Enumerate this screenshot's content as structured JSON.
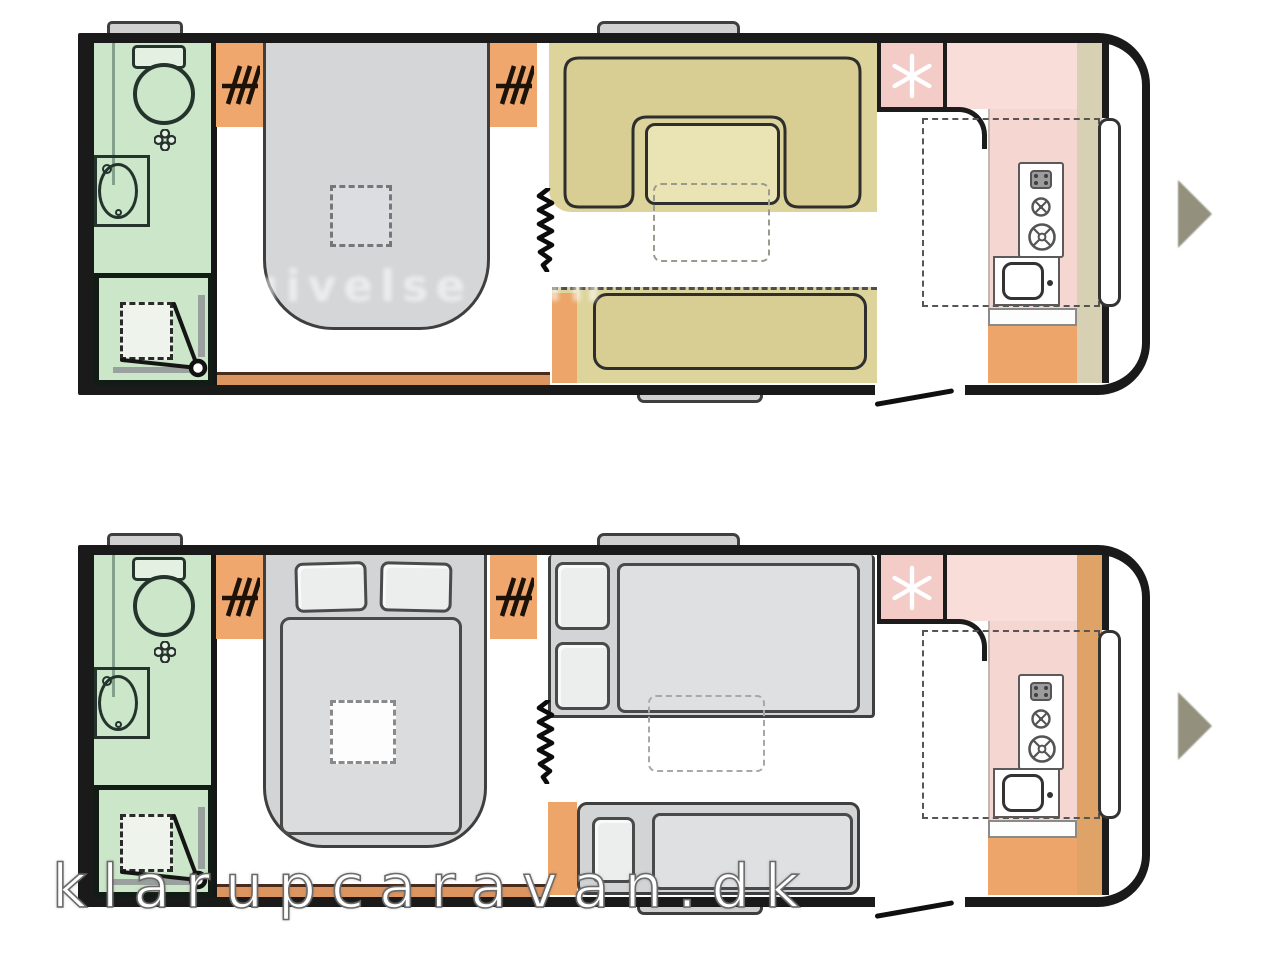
{
  "image": {
    "subject": "caravan floor plans",
    "plan_count": 2,
    "plans": [
      {
        "name": "floorplan-day-layout",
        "features": [
          "bathroom",
          "wardrobe",
          "island-bed",
          "curtain-divider",
          "u-shaped-dinette",
          "table",
          "bench-sofa",
          "kitchen",
          "fridge",
          "stove",
          "sink",
          "entrance-door"
        ]
      },
      {
        "name": "floorplan-night-layout",
        "features": [
          "bathroom",
          "wardrobe",
          "island-bed-made-up",
          "curtain-divider",
          "converted-double-bed",
          "single-bed",
          "stowed-table",
          "kitchen",
          "fridge",
          "stove",
          "sink",
          "entrance-door"
        ]
      }
    ]
  },
  "watermarks": {
    "faint": "givelse kun",
    "site": "klarupcaravan.dk"
  },
  "palette": {
    "bathroom_green": "#cbe6c8",
    "wardrobe_orange": "#efa76e",
    "sofa_tan": "#d8cd92",
    "platform_tan": "#ddd49c",
    "table_tan": "#eae3b4",
    "bed_grey": "#d2d4d6",
    "mattress_grey": "#dfe0e1",
    "kitchen_pink": "#f6d6d1",
    "fridge_pink": "#f3ccc8",
    "side_strip_beige": "#d8d0b2",
    "side_strip_orange": "#dfa267",
    "cabinet_orange": "#eda569",
    "floor_strip_orange": "#dd9560",
    "outline_black": "#1a1a1a",
    "arrow_grey": "#8e8b78"
  },
  "icons": [
    "snowflake-icon",
    "wardrobe-rail-icon",
    "stove-burner-icon",
    "sink-icon",
    "toilet-icon",
    "washbasin-icon",
    "shower-icon",
    "curtain-zigzag-icon",
    "door-swing-icon",
    "next-arrow-icon",
    "roof-vent-tab",
    "window-tab"
  ]
}
